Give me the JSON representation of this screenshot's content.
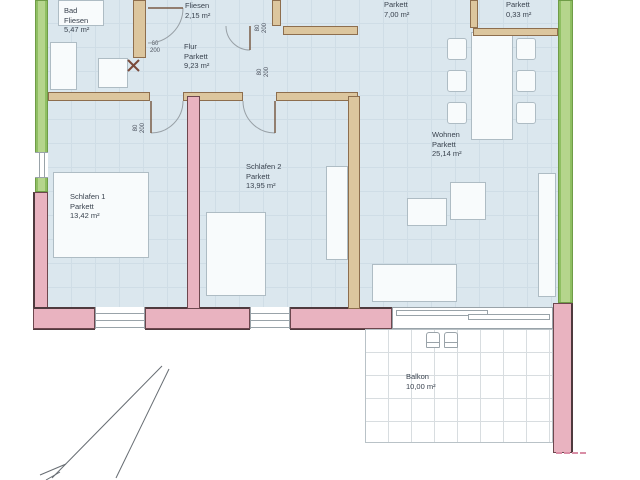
{
  "plan": {
    "type": "apartment-floor-plan",
    "rooms": {
      "bad": {
        "name": "Bad",
        "floor": "Fliesen",
        "area": "5,47 m²"
      },
      "wc": {
        "floor": "Fliesen",
        "area": "2,15 m²"
      },
      "flur": {
        "name": "Flur",
        "floor": "Parkett",
        "area": "9,23 m²"
      },
      "kochen": {
        "floor": "Parkett",
        "area": "7,00 m²"
      },
      "abstell": {
        "floor": "Parkett",
        "area": "0,33 m²"
      },
      "schlafen1": {
        "name": "Schlafen 1",
        "floor": "Parkett",
        "area": "13,42 m²"
      },
      "schlafen2": {
        "name": "Schlafen 2",
        "floor": "Parkett",
        "area": "13,95 m²"
      },
      "wohnen": {
        "name": "Wohnen",
        "floor": "Parkett",
        "area": "25,14 m²"
      },
      "balkon": {
        "name": "Balkon",
        "area": "10,00 m²"
      }
    },
    "dims": {
      "door_bad_w": "60",
      "door_bad_h": "200",
      "door_wc_w": "80",
      "door_wc_h": "200",
      "door_s1_w": "80",
      "door_s1_h": "200",
      "door_s2_w": "80",
      "door_s2_h": "200"
    },
    "colors": {
      "floor": "#dbe7ee",
      "wall_green": "#b5d58c",
      "wall_pink": "#e9b3c0",
      "wall_tan": "#dcc69e",
      "ink": "#39424e"
    }
  }
}
